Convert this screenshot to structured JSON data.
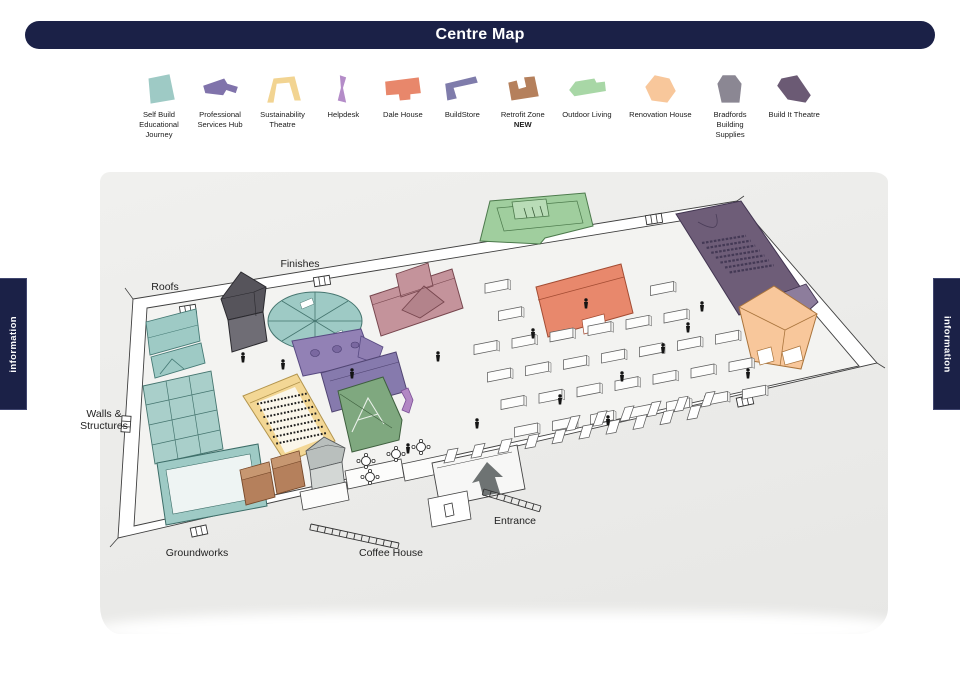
{
  "header": {
    "title": "Centre Map"
  },
  "tabs": {
    "left": "information",
    "right": "information"
  },
  "colors": {
    "navy": "#1b2147",
    "paper": "#ececea",
    "self_build": "#9ecac5",
    "professional_services": "#8073ab",
    "sustainability": "#f2d492",
    "helpdesk": "#b48cc8",
    "dale_house": "#e8876b",
    "buildstore": "#7f7cab",
    "retrofit": "#b5805c",
    "outdoor_living": "#a8d7a6",
    "renovation": "#f8c79b",
    "bradfords": "#8b8793",
    "build_it_theatre": "#6b5a74"
  },
  "legend": {
    "items": [
      {
        "id": "self-build",
        "label": "Self Build\nEducational\nJourney",
        "color": "#9ecac5"
      },
      {
        "id": "professional-services",
        "label": "Professional\nServices Hub",
        "color": "#8073ab"
      },
      {
        "id": "sustainability-theatre",
        "label": "Sustainability\nTheatre",
        "color": "#f2d492"
      },
      {
        "id": "helpdesk",
        "label": "Helpdesk",
        "color": "#b48cc8"
      },
      {
        "id": "dale-house",
        "label": "Dale House",
        "color": "#e8876b"
      },
      {
        "id": "buildstore",
        "label": "BuildStore",
        "color": "#7f7cab"
      },
      {
        "id": "retrofit-zone",
        "label": "Retrofit Zone",
        "sublabel": "NEW",
        "color": "#b5805c"
      },
      {
        "id": "outdoor-living",
        "label": "Outdoor Living",
        "color": "#a8d7a6"
      },
      {
        "id": "renovation-house",
        "label": "Renovation House",
        "color": "#f8c79b"
      },
      {
        "id": "bradfords",
        "label": "Bradfords\nBuilding\nSupplies",
        "color": "#8b8793"
      },
      {
        "id": "build-it-theatre",
        "label": "Build It Theatre",
        "color": "#6b5a74"
      }
    ]
  },
  "map": {
    "labels": {
      "finishes": "Finishes",
      "roofs": "Roofs",
      "walls_line1": "Walls &",
      "walls_line2": "Structures",
      "groundworks": "Groundworks",
      "coffee_house": "Coffee House",
      "entrance": "Entrance"
    }
  }
}
